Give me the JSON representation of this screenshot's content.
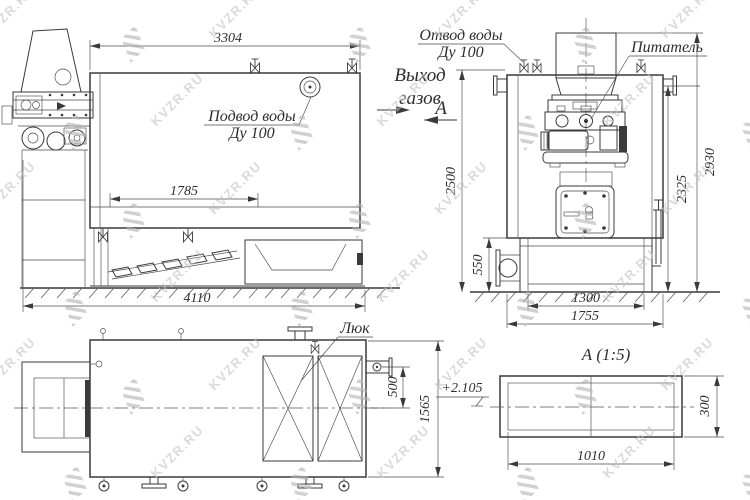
{
  "watermark": {
    "text": "KVZR.RU"
  },
  "colors": {
    "line": "#3a3a3a",
    "dim_text": "#2e2e2e",
    "watermark": "#c4c4c4",
    "background": "#ffffff"
  },
  "side_view": {
    "dim_length_top": "3304",
    "dim_grate_length": "1785",
    "dim_length_overall": "4110",
    "water_inlet_label_1": "Подвод воды",
    "water_inlet_label_2": "Ду 100",
    "gas_outlet_label_1": "Выход",
    "gas_outlet_label_2": "газов",
    "view_direction_label": "А"
  },
  "front_view": {
    "water_outlet_label_1": "Отвод воды",
    "water_outlet_label_2": "Ду 100",
    "feeder_label": "Питатель",
    "dim_height_water_outlet": "2500",
    "dim_ash_box_height": "550",
    "dim_base_width": "1300",
    "dim_body_width": "1755",
    "dim_height_body": "2325",
    "dim_height_overall": "2930"
  },
  "plan_view": {
    "hatch_label": "Люк",
    "dim_gas_duct_offset": "500",
    "dim_width_overall": "1565",
    "elevation_mark": "+2.105"
  },
  "section_view": {
    "title": "А (1:5)",
    "dim_inner_width": "1010",
    "dim_inner_height": "300"
  }
}
